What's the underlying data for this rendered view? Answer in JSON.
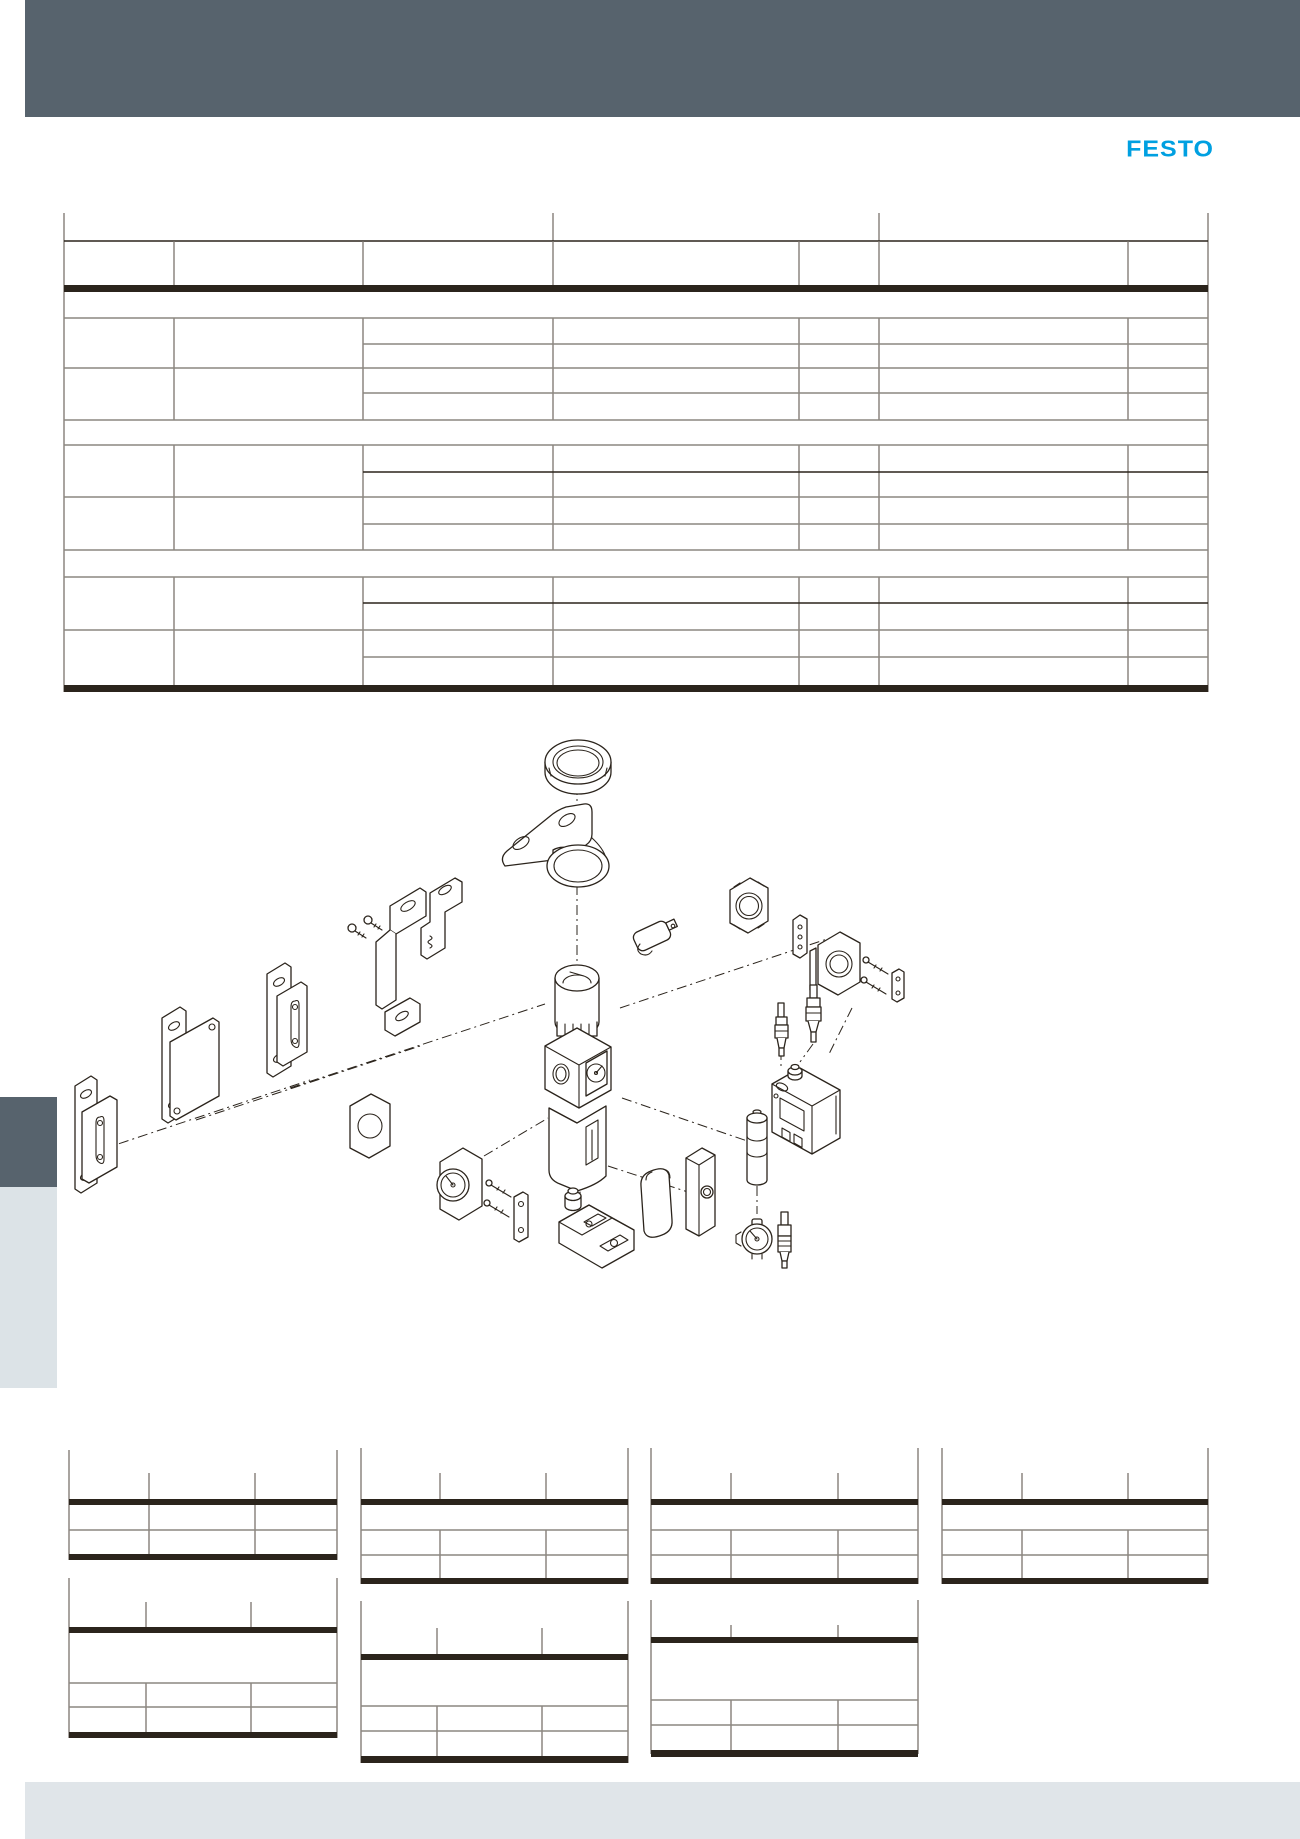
{
  "brand": {
    "logo_text": "FESTO"
  },
  "colors": {
    "band": "#57636d",
    "brand": "#00a0e1",
    "tab_light": "#dce3e7",
    "footer": "#e0e5e9",
    "table_line": "#8c8780",
    "table_strong": "#2b241c",
    "ink": "#2b241c"
  },
  "main_table": {
    "columns": 7,
    "section_bands": 3,
    "data_rows": 6,
    "sub_rows_per_data_row": 2,
    "cells_empty": true
  },
  "accessory_tables": [
    {
      "id": "accessory-table-1",
      "columns": 3,
      "rows": 2
    },
    {
      "id": "accessory-table-2",
      "columns": 3,
      "rows": 3
    },
    {
      "id": "accessory-table-3",
      "columns": 3,
      "rows": 3
    },
    {
      "id": "accessory-table-4",
      "columns": 3,
      "rows": 3
    },
    {
      "id": "accessory-table-5",
      "columns": 3,
      "rows": 3
    },
    {
      "id": "accessory-table-6",
      "columns": 3,
      "rows": 3
    },
    {
      "id": "accessory-table-7",
      "columns": 3,
      "rows": 3
    }
  ],
  "diagram": {
    "parts": [
      "ring-lock-nut",
      "mounting-bracket",
      "wall-mounting-plate-small",
      "wall-mounting-plate-medium",
      "wall-mounting-plate-large",
      "angle-bracket-set",
      "fastening-screws",
      "cable-clip",
      "module-connector-plate",
      "spacer-plate",
      "module-clamp-unit",
      "clamp-bolts",
      "clamp-end-plate",
      "cover-plate",
      "pressure-gauge",
      "gauge-mounting-bolts",
      "gauge-mounting-plate",
      "filter-regulator-unit",
      "soft-start-valve-unit",
      "protective-cover",
      "push-button-module",
      "cartridge-module",
      "pressure-sensor-unit",
      "plug-connector-small",
      "plug-connector-large",
      "pressure-indicator",
      "plug-socket-connector"
    ]
  }
}
